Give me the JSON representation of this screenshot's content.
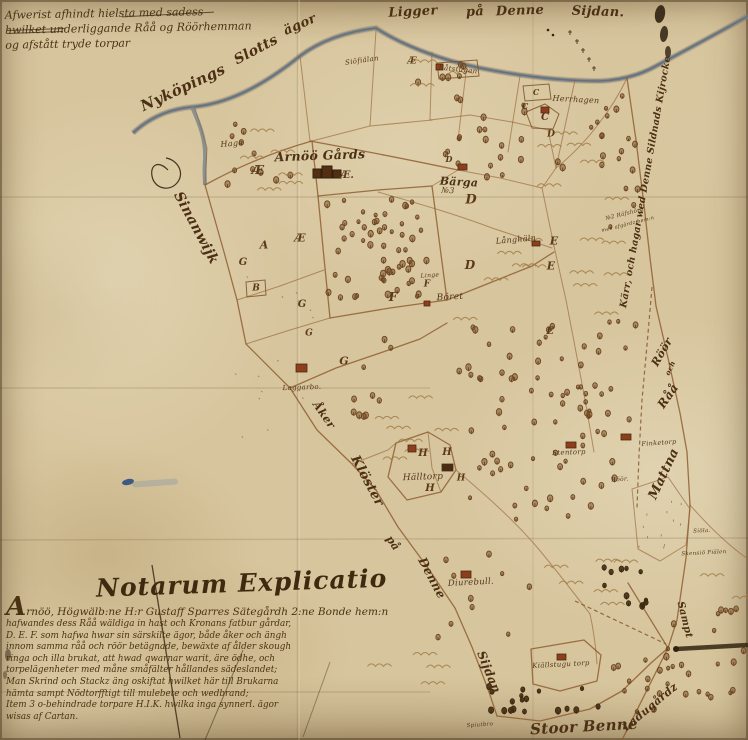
{
  "meta": {
    "description": "Hand-drawn 17th century Swedish cadastral map of the Arnöö estate by Nyköping"
  },
  "colors": {
    "parchment": "#d7c59d",
    "ink": "#53361a",
    "boundary": "#8e5a2e",
    "water": "#7b8790",
    "building": "#8f3e1c",
    "blue_mark": "#2e4f80"
  },
  "top_note": {
    "lines": [
      "Afwerist afhindt hielsta med sadess",
      "hwilket underliggande Råå og Röörhemman",
      "og afstått tryde torpar"
    ]
  },
  "legend": {
    "heading": "Notarum Explicatio",
    "lines": [
      "Arnöö, Högwälb:ne H:r Gustaff Sparres Sätegårdh 2:ne Bonde hem:n",
      "hafwandes dess Råå wäldiga in hast och Kronans fatbur gårdar,",
      "D. E. F. som hafwa hwar sin särskilte ägor, både åker och ängh",
      "innom samma råå och röör betägnade, bewäxte af ålder skough",
      "ringa och illa brukat, att hwad qwarnar warit, äre ödhe, och",
      "torpelägenheter med måne småfälter hållandes sädeslandet;",
      "Man Skrind och Stackz äng oskiftat hwilket här till Brukarna",
      "hämta sampt Nödtorfftigt till mulebete och wedbrand;",
      "Item 3 o-behindrade torpare H.I.K. hwilka inga synnerl. ägor",
      "wisas af Cartan."
    ]
  },
  "labels": [
    {
      "text": "Ligger",
      "x": 413,
      "y": 12,
      "rot": -3,
      "size": 13,
      "b": 1
    },
    {
      "text": "på",
      "x": 475,
      "y": 12,
      "rot": -3,
      "size": 13,
      "b": 1
    },
    {
      "text": "Denne",
      "x": 520,
      "y": 11,
      "rot": -2,
      "size": 13,
      "b": 1
    },
    {
      "text": "Sijdan.",
      "x": 598,
      "y": 12,
      "rot": 2,
      "size": 13,
      "b": 1
    },
    {
      "text": "Nyköpings",
      "x": 183,
      "y": 88,
      "rot": -25,
      "size": 15,
      "b": 1
    },
    {
      "text": "Slotts",
      "x": 256,
      "y": 50,
      "rot": -28,
      "size": 14,
      "b": 1
    },
    {
      "text": "ägor",
      "x": 300,
      "y": 25,
      "rot": -24,
      "size": 13,
      "b": 1
    },
    {
      "text": "Siöfiälan",
      "x": 362,
      "y": 61,
      "rot": -8,
      "size": 7
    },
    {
      "text": "Hage",
      "x": 232,
      "y": 144,
      "rot": -5,
      "size": 8
    },
    {
      "text": "Arnöö Gårds",
      "x": 320,
      "y": 156,
      "rot": -2,
      "size": 12.5,
      "b": 1
    },
    {
      "text": "Sinanwijk",
      "x": 196,
      "y": 228,
      "rot": 62,
      "size": 14,
      "b": 1
    },
    {
      "text": "Båtstugan",
      "x": 458,
      "y": 70,
      "rot": 6,
      "size": 7
    },
    {
      "text": "Herrhagen",
      "x": 576,
      "y": 100,
      "rot": 3,
      "size": 8
    },
    {
      "text": "Bärga",
      "x": 459,
      "y": 182,
      "rot": 3,
      "size": 11,
      "b": 1
    },
    {
      "text": "№3",
      "x": 448,
      "y": 191,
      "rot": 3,
      "size": 8
    },
    {
      "text": "Långhäln",
      "x": 516,
      "y": 240,
      "rot": -5,
      "size": 8
    },
    {
      "text": "Linge",
      "x": 430,
      "y": 276,
      "rot": -4,
      "size": 6
    },
    {
      "text": "Böret",
      "x": 450,
      "y": 298,
      "rot": -3,
      "size": 9
    },
    {
      "text": "Laggarbo.",
      "x": 302,
      "y": 388,
      "rot": -2,
      "size": 7
    },
    {
      "text": "Åker",
      "x": 324,
      "y": 415,
      "rot": 55,
      "size": 11,
      "b": 1
    },
    {
      "text": "Klöster",
      "x": 367,
      "y": 481,
      "rot": 62,
      "size": 13,
      "b": 1
    },
    {
      "text": "på",
      "x": 393,
      "y": 543,
      "rot": 55,
      "size": 11,
      "b": 1
    },
    {
      "text": "Denne",
      "x": 432,
      "y": 578,
      "rot": 62,
      "size": 12,
      "b": 1
    },
    {
      "text": "Sijdan",
      "x": 489,
      "y": 672,
      "rot": 68,
      "size": 12,
      "b": 1
    },
    {
      "text": "Hälltorp",
      "x": 423,
      "y": 478,
      "rot": -2,
      "size": 9
    },
    {
      "text": "Stentorp",
      "x": 569,
      "y": 453,
      "rot": -2,
      "size": 7
    },
    {
      "text": "Finketorp",
      "x": 659,
      "y": 443,
      "rot": -4,
      "size": 6.5
    },
    {
      "text": "Röör.",
      "x": 620,
      "y": 480,
      "rot": -3,
      "size": 6
    },
    {
      "text": "Råå",
      "x": 668,
      "y": 396,
      "rot": -55,
      "size": 12,
      "b": 1
    },
    {
      "text": "och",
      "x": 670,
      "y": 368,
      "rot": -65,
      "size": 7,
      "b": 1
    },
    {
      "text": "Röör",
      "x": 662,
      "y": 352,
      "rot": -60,
      "size": 11,
      "b": 1
    },
    {
      "text": "Mattna",
      "x": 664,
      "y": 474,
      "rot": -65,
      "size": 13,
      "b": 1
    },
    {
      "text": "Siöla.",
      "x": 702,
      "y": 532,
      "rot": -3,
      "size": 5.5
    },
    {
      "text": "Skensiö Fiälen",
      "x": 704,
      "y": 554,
      "rot": -3,
      "size": 5.5
    },
    {
      "text": "№2 Räfshörn",
      "x": 625,
      "y": 215,
      "rot": -14,
      "size": 5.5
    },
    {
      "text": "med afgärdz hem:n",
      "x": 628,
      "y": 225,
      "rot": -14,
      "size": 5
    },
    {
      "text": "Kärr, och hagar wed Denne Sildnads Kijrocke",
      "x": 646,
      "y": 182,
      "rot": -80,
      "size": 9.5,
      "b": 1
    },
    {
      "text": "Diurebull.",
      "x": 471,
      "y": 583,
      "rot": -3,
      "size": 8.5
    },
    {
      "text": "Kiällstugu torp",
      "x": 561,
      "y": 665,
      "rot": -3,
      "size": 7
    },
    {
      "text": "Spiutbro",
      "x": 480,
      "y": 726,
      "rot": -4,
      "size": 5.5
    },
    {
      "text": "Stoor Benne",
      "x": 584,
      "y": 727,
      "rot": -3,
      "size": 15,
      "b": 1
    },
    {
      "text": "Ladugårdz",
      "x": 650,
      "y": 707,
      "rot": -40,
      "size": 11,
      "b": 1
    },
    {
      "text": "Sampt",
      "x": 684,
      "y": 620,
      "rot": 76,
      "size": 10,
      "b": 1
    }
  ],
  "letters": [
    {
      "ch": "Æ",
      "x": 258,
      "y": 170,
      "size": 12
    },
    {
      "ch": "Æ.",
      "x": 347,
      "y": 176,
      "size": 10
    },
    {
      "ch": "Æ",
      "x": 412,
      "y": 62,
      "size": 9
    },
    {
      "ch": "A",
      "x": 264,
      "y": 245,
      "size": 11
    },
    {
      "ch": "Æ",
      "x": 300,
      "y": 238,
      "size": 11
    },
    {
      "ch": "B",
      "x": 256,
      "y": 289,
      "size": 9
    },
    {
      "ch": "G",
      "x": 243,
      "y": 263,
      "size": 10
    },
    {
      "ch": "G",
      "x": 302,
      "y": 305,
      "size": 10
    },
    {
      "ch": "G",
      "x": 309,
      "y": 334,
      "size": 9
    },
    {
      "ch": "G",
      "x": 344,
      "y": 361,
      "size": 11
    },
    {
      "ch": "F",
      "x": 393,
      "y": 297,
      "size": 12
    },
    {
      "ch": "F",
      "x": 427,
      "y": 285,
      "size": 9
    },
    {
      "ch": "C",
      "x": 536,
      "y": 92,
      "size": 8
    },
    {
      "ch": "C",
      "x": 525,
      "y": 106,
      "size": 8
    },
    {
      "ch": "C",
      "x": 545,
      "y": 118,
      "size": 10
    },
    {
      "ch": "D",
      "x": 449,
      "y": 159,
      "size": 8
    },
    {
      "ch": "D",
      "x": 471,
      "y": 200,
      "size": 13
    },
    {
      "ch": "D",
      "x": 470,
      "y": 265,
      "size": 12
    },
    {
      "ch": "D",
      "x": 551,
      "y": 135,
      "size": 9
    },
    {
      "ch": "E",
      "x": 554,
      "y": 241,
      "size": 11
    },
    {
      "ch": "E",
      "x": 551,
      "y": 266,
      "size": 11
    },
    {
      "ch": "E",
      "x": 550,
      "y": 332,
      "size": 10
    },
    {
      "ch": "H",
      "x": 423,
      "y": 454,
      "size": 10
    },
    {
      "ch": "H",
      "x": 447,
      "y": 453,
      "size": 10
    },
    {
      "ch": "H",
      "x": 430,
      "y": 489,
      "size": 10
    },
    {
      "ch": "H",
      "x": 461,
      "y": 479,
      "size": 9
    }
  ],
  "buildings": [
    {
      "x": 313,
      "y": 166,
      "w": 22,
      "h": 12,
      "type": "manor"
    },
    {
      "x": 458,
      "y": 164,
      "w": 9,
      "h": 6
    },
    {
      "x": 436,
      "y": 64,
      "w": 7,
      "h": 6
    },
    {
      "x": 541,
      "y": 107,
      "w": 8,
      "h": 6
    },
    {
      "x": 532,
      "y": 241,
      "w": 8,
      "h": 5
    },
    {
      "x": 424,
      "y": 301,
      "w": 6,
      "h": 5
    },
    {
      "x": 296,
      "y": 364,
      "w": 11,
      "h": 8
    },
    {
      "x": 408,
      "y": 445,
      "w": 8,
      "h": 7
    },
    {
      "x": 442,
      "y": 464,
      "w": 11,
      "h": 7,
      "dark": 1
    },
    {
      "x": 566,
      "y": 442,
      "w": 10,
      "h": 6
    },
    {
      "x": 621,
      "y": 434,
      "w": 10,
      "h": 6
    },
    {
      "x": 461,
      "y": 571,
      "w": 10,
      "h": 7
    },
    {
      "x": 557,
      "y": 654,
      "w": 9,
      "h": 6
    }
  ]
}
